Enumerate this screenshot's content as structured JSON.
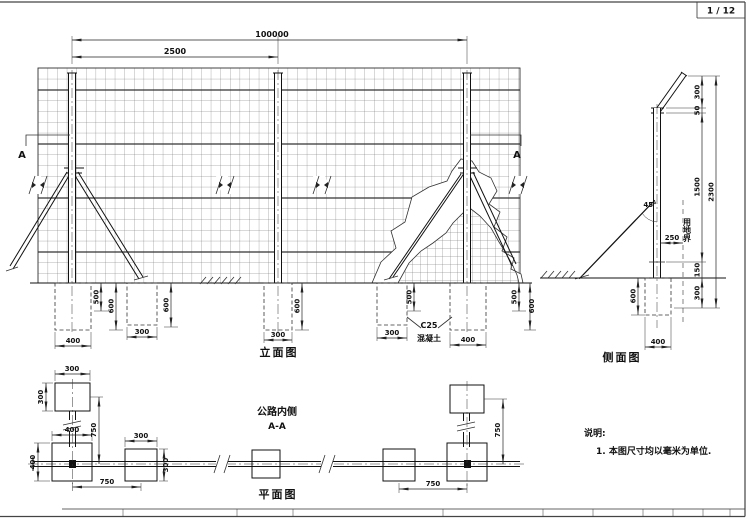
{
  "page": {
    "number": "1 / 12"
  },
  "views": {
    "elevation": {
      "title": "立面图"
    },
    "side": {
      "title": "侧面图"
    },
    "plan": {
      "title": "平面图"
    },
    "section": {
      "location": "公路内侧",
      "name": "A-A",
      "marker": "A"
    }
  },
  "notes": {
    "title": "说明:",
    "item1": "1. 本图尺寸均以毫米为单位."
  },
  "materials": {
    "grade": "C25",
    "name": "混凝土"
  },
  "labels": {
    "boundary": "用地界",
    "angle": "45°"
  },
  "dims": {
    "elevation": {
      "total": "100000",
      "spacing": "2500",
      "post_footing_w": "400",
      "brace_footing_w": "300",
      "mid_footing_w": "300",
      "depth_a": "500",
      "depth_b": "600"
    },
    "side": {
      "arm": "300",
      "lap": "50",
      "upper": "1500",
      "clearance": "150",
      "embed": "300",
      "total": "2300",
      "offset": "250",
      "footing_depth": "600",
      "footing_w": "400"
    },
    "plan": {
      "top_plate": "300",
      "base_plate": "400",
      "anchor_plate": "300",
      "span": "750"
    }
  }
}
